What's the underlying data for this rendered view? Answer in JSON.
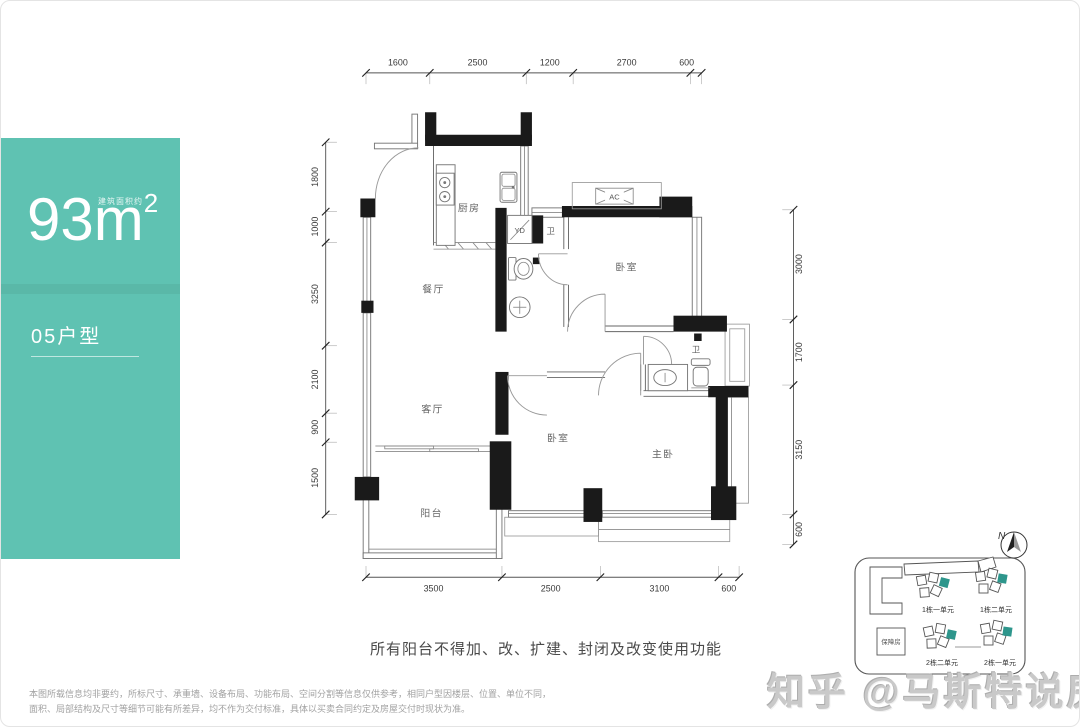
{
  "sidebar": {
    "area_note": "建筑面积约",
    "area_value": "93",
    "area_unit": "m",
    "area_exp": "2",
    "unit_type": "05户型"
  },
  "plan": {
    "rooms": {
      "kitchen": "厨房",
      "dining": "餐厅",
      "living": "客厅",
      "balcony": "阳台",
      "bedroom1": "卧室",
      "bedroom2": "卧室",
      "master": "主卧",
      "bath1": "卫",
      "bath2": "卫",
      "laundry": "YD",
      "ac": "AC"
    },
    "dims": {
      "top": [
        "1600",
        "2500",
        "1200",
        "2700",
        "600"
      ],
      "left": [
        "1800",
        "1000",
        "3250",
        "2100",
        "900",
        "1500"
      ],
      "right": [
        "3000",
        "1700",
        "3150",
        "600"
      ],
      "bottom": [
        "3500",
        "2500",
        "3100",
        "600"
      ]
    }
  },
  "notice": "所有阳台不得加、改、扩建、封闭及改变使用功能",
  "disclaimer": {
    "line1": "本图所载信息均非要约，所标尺寸、承重墙、设备布局、功能布局、空间分割等信息仅供参考，相同户型因楼层、位置、单位不同，",
    "line2": "面积、局部结构及尺寸等细节可能有所差异，均不作为交付标准，具体以买卖合同约定及房屋交付时现状为准。"
  },
  "sitemap": {
    "north": "N",
    "labels": {
      "b1u1": "1栋一单元",
      "b1u2": "1栋二单元",
      "b2u2": "2栋二单元",
      "b2u1": "2栋一单元",
      "support": "保障房"
    }
  },
  "watermark": "知乎 @马斯特说房",
  "colors": {
    "teal": "#5FC2B2",
    "wall": "#1A1A1A",
    "highlight": "#2E968C"
  }
}
